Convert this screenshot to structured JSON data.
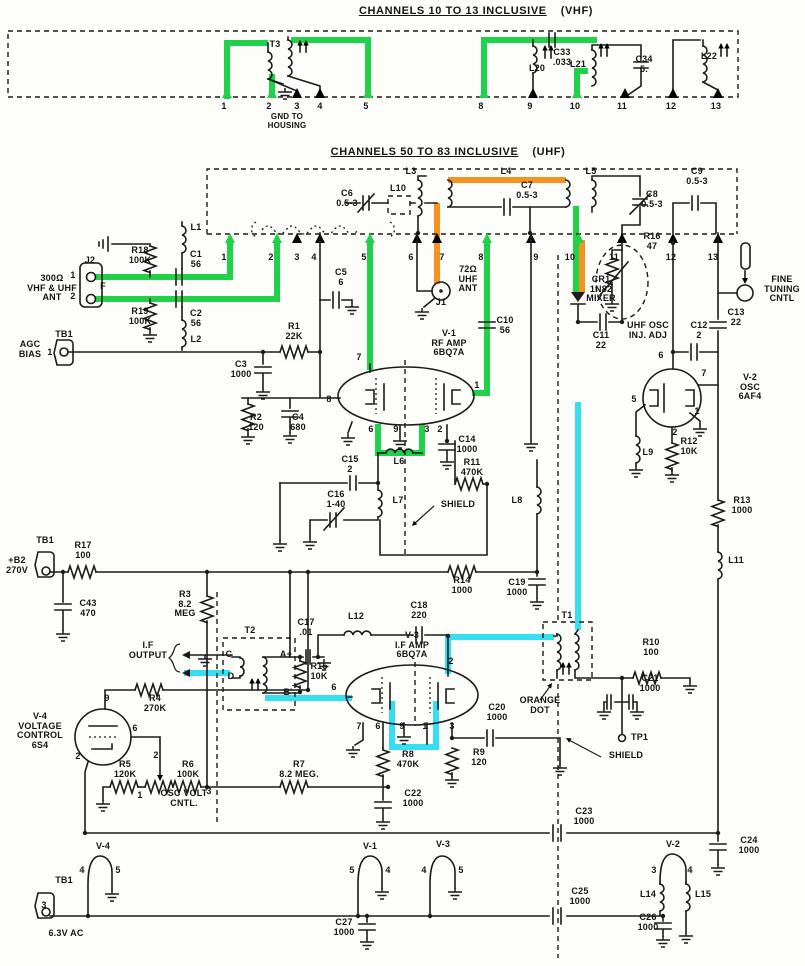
{
  "header": {
    "vhf_title": "CHANNELS 10 TO 13 INCLUSIVE",
    "vhf_suffix": "(VHF)",
    "uhf_title": "CHANNELS 50 TO 83 INCLUSIVE",
    "uhf_suffix": "(UHF)"
  },
  "colors": {
    "highlight_green": "#1fd24a",
    "highlight_orange": "#f6921e",
    "highlight_cyan": "#35dff0",
    "ink": "#1b1b1b",
    "paper": "#fdfdfa"
  },
  "terminals": {
    "vhf": [
      "1",
      "2",
      "3",
      "4",
      "5",
      "8",
      "9",
      "10",
      "11",
      "12",
      "13"
    ],
    "uhf": [
      "1",
      "2",
      "3",
      "4",
      "5",
      "6",
      "7",
      "8",
      "9",
      "10",
      "11",
      "12",
      "13"
    ]
  },
  "tubes": {
    "v1": {
      "name": "V-1\nRF AMP\n6BQ7A",
      "pins": [
        "7",
        "8",
        "6",
        "9",
        "3",
        "2",
        "1"
      ]
    },
    "v2": {
      "name": "V-2\nOSC\n6AF4",
      "pins": [
        "6",
        "7",
        "5",
        "1",
        "2"
      ]
    },
    "v3": {
      "name": "V-3\nI.F AMP\n6BQ7A",
      "pins": [
        "6",
        "2",
        "7",
        "6",
        "9",
        "1",
        "3"
      ]
    },
    "v4": {
      "name": "V-4\nVOLTAGE\nCONTROL\n6S4",
      "pins": [
        "9",
        "6",
        "2"
      ]
    },
    "heaters": {
      "v4": {
        "name": "V-4",
        "pins": [
          "4",
          "5"
        ]
      },
      "v1": {
        "name": "V-1",
        "pins": [
          "5",
          "4"
        ]
      },
      "v3": {
        "name": "V-3",
        "pins": [
          "4",
          "5"
        ]
      },
      "v2": {
        "name": "V-2",
        "pins": [
          "3",
          "4"
        ]
      }
    }
  },
  "labels": {
    "t3": "T3",
    "gnd_housing": "GND TO\nHOUSING",
    "c33": "C33\n.033",
    "l20": "L20",
    "l21": "L21",
    "c34": "C34\n5.",
    "l22": "L22",
    "l3": "L3",
    "l10": "L10",
    "c6": "C6\n0.5-3",
    "l4": "L4",
    "c7": "C7\n0.5-3",
    "l5": "L5",
    "c8": "C8\n0.5-3",
    "c9": "C9\n0.5-3",
    "r16": "R16\n47",
    "ant300": "300Ω\nVHF & UHF\nANT",
    "j2": "J2",
    "j2_1": "1",
    "j2_2": "2",
    "j2_f": "F",
    "r18": "R18\n100K",
    "r19": "R19\n100K",
    "l1": "L1",
    "c1": "C1\n56",
    "c2": "C2\n56",
    "l2": "L2",
    "tb1_agc": "TB1",
    "agc_bias": "AGC\nBIAS",
    "agc_1": "1",
    "c5": "C5\n6",
    "ant72": "72Ω\nUHF\nANT",
    "j1": "J1",
    "c10": "C10\n56",
    "r1": "R1\n22K",
    "c3": "C3\n1000",
    "r2": "R2\n120",
    "c4": "C4\n680",
    "c15": "C15\n2",
    "l6": "L6",
    "c14": "C14\n1000",
    "r11": "R11\n470K",
    "c16": "C16\n1-40",
    "l7": "L7",
    "shield1": "SHIELD",
    "l8": "L8",
    "cr1": "CR1\n1N82\nMIXER",
    "uhf_osc": "UHF OSC\nINJ. ADJ",
    "c11": "C11\n22",
    "c12": "C12\n2",
    "c13": "C13\n22",
    "fine_tuning": "FINE\nTUNING\nCNTL",
    "l9": "L9",
    "r12": "R12\n10K",
    "r13": "R13\n1000",
    "l11": "L11",
    "tb1_b2": "TB1",
    "b2": "+B2\n270V",
    "r17": "R17\n100",
    "c43": "C43\n470",
    "r3": "R3\n8.2\nMEG",
    "r14": "R14\n1000",
    "c19": "C19\n1000",
    "if_output": "I.F\nOUTPUT",
    "t2": "T2",
    "t2_c": "C",
    "t2_d": "D",
    "t2_a": "A+",
    "t2_b": "B'",
    "c17": "C17\n.01",
    "r15": "R15\n10K",
    "r4": "R4\n270K",
    "l12": "L12",
    "c18": "C18\n220",
    "t1": "T1",
    "orange_dot": "ORANGE\nDOT",
    "r10": "R10\n100",
    "c21": "C21\n1000",
    "tp1": "TP1",
    "shield2": "SHIELD",
    "r5": "R5\n120K",
    "r6": "R6\n100K",
    "r7": "R7\n8.2 MEG.",
    "osc_volt": "OSC VOLT\nCNTL.",
    "pot_1": "1",
    "pot_2": "2",
    "pot_3": "3",
    "r8": "R8\n470K",
    "r9": "R9\n120",
    "c20": "C20\n1000",
    "c22": "C22\n1000",
    "c23": "C23\n1000",
    "c24": "C24\n1000",
    "c25": "C25\n1000",
    "c26": "C26\n1000",
    "c27": "C27\n1000",
    "l14": "L14",
    "l15": "L15",
    "tb1_heater": "TB1",
    "tb1_3": "3",
    "vac": "6.3V AC"
  }
}
